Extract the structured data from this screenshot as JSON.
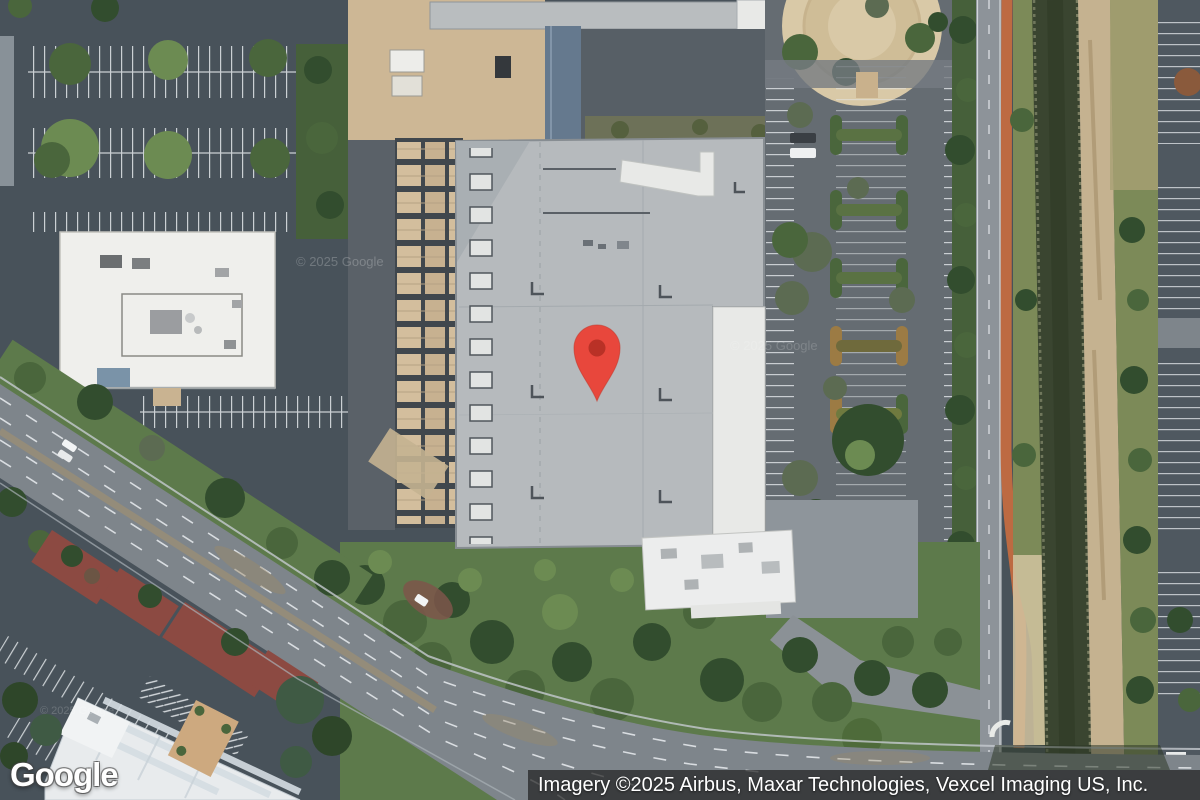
{
  "branding": {
    "logo_text": "Google"
  },
  "attribution": {
    "text": "Imagery ©2025 Airbus, Maxar Technologies, Vexcel Imaging US, Inc."
  },
  "map": {
    "view_type": "satellite",
    "watermark": "© 2025 Google",
    "marker": {
      "kind": "red-place-pin"
    }
  },
  "colors": {
    "base": "#48525A",
    "lotMid": "#656C72",
    "road": "#7E858B",
    "stripe": "#E3E7EA",
    "bldg": "#B6BABD",
    "bldgDk": "#A9AFB3",
    "bldgEdge": "#878D92",
    "white": "#EFEFEC",
    "whiteRoof": "#E8E9E7",
    "hvacBg": "#40474D",
    "hvacTan": "#D3BE9D",
    "tan": "#CDB795",
    "plaza": "#D9C9A7",
    "plazaRing": "#C7B38D",
    "treeDark": "#324D2E",
    "treeMid": "#4A663C",
    "treeLight": "#6C8B52",
    "treeGray": "#5C6B52",
    "grass": "#5D7A4B",
    "grassDark": "#46603A",
    "scrub": "#6D7158",
    "canal": "#3A4530",
    "bank": "#C5B290",
    "bankGrass": "#7C8A58",
    "bike": "#BD6A42",
    "maroon": "#8C4A42",
    "walkBlue": "#65798E",
    "pin": "#E8473C",
    "pinDot": "#B93126",
    "logoText": "#FFFFFF",
    "attrBg": "rgba(33,33,33,0.72)",
    "attrText": "#FFFFFF"
  }
}
